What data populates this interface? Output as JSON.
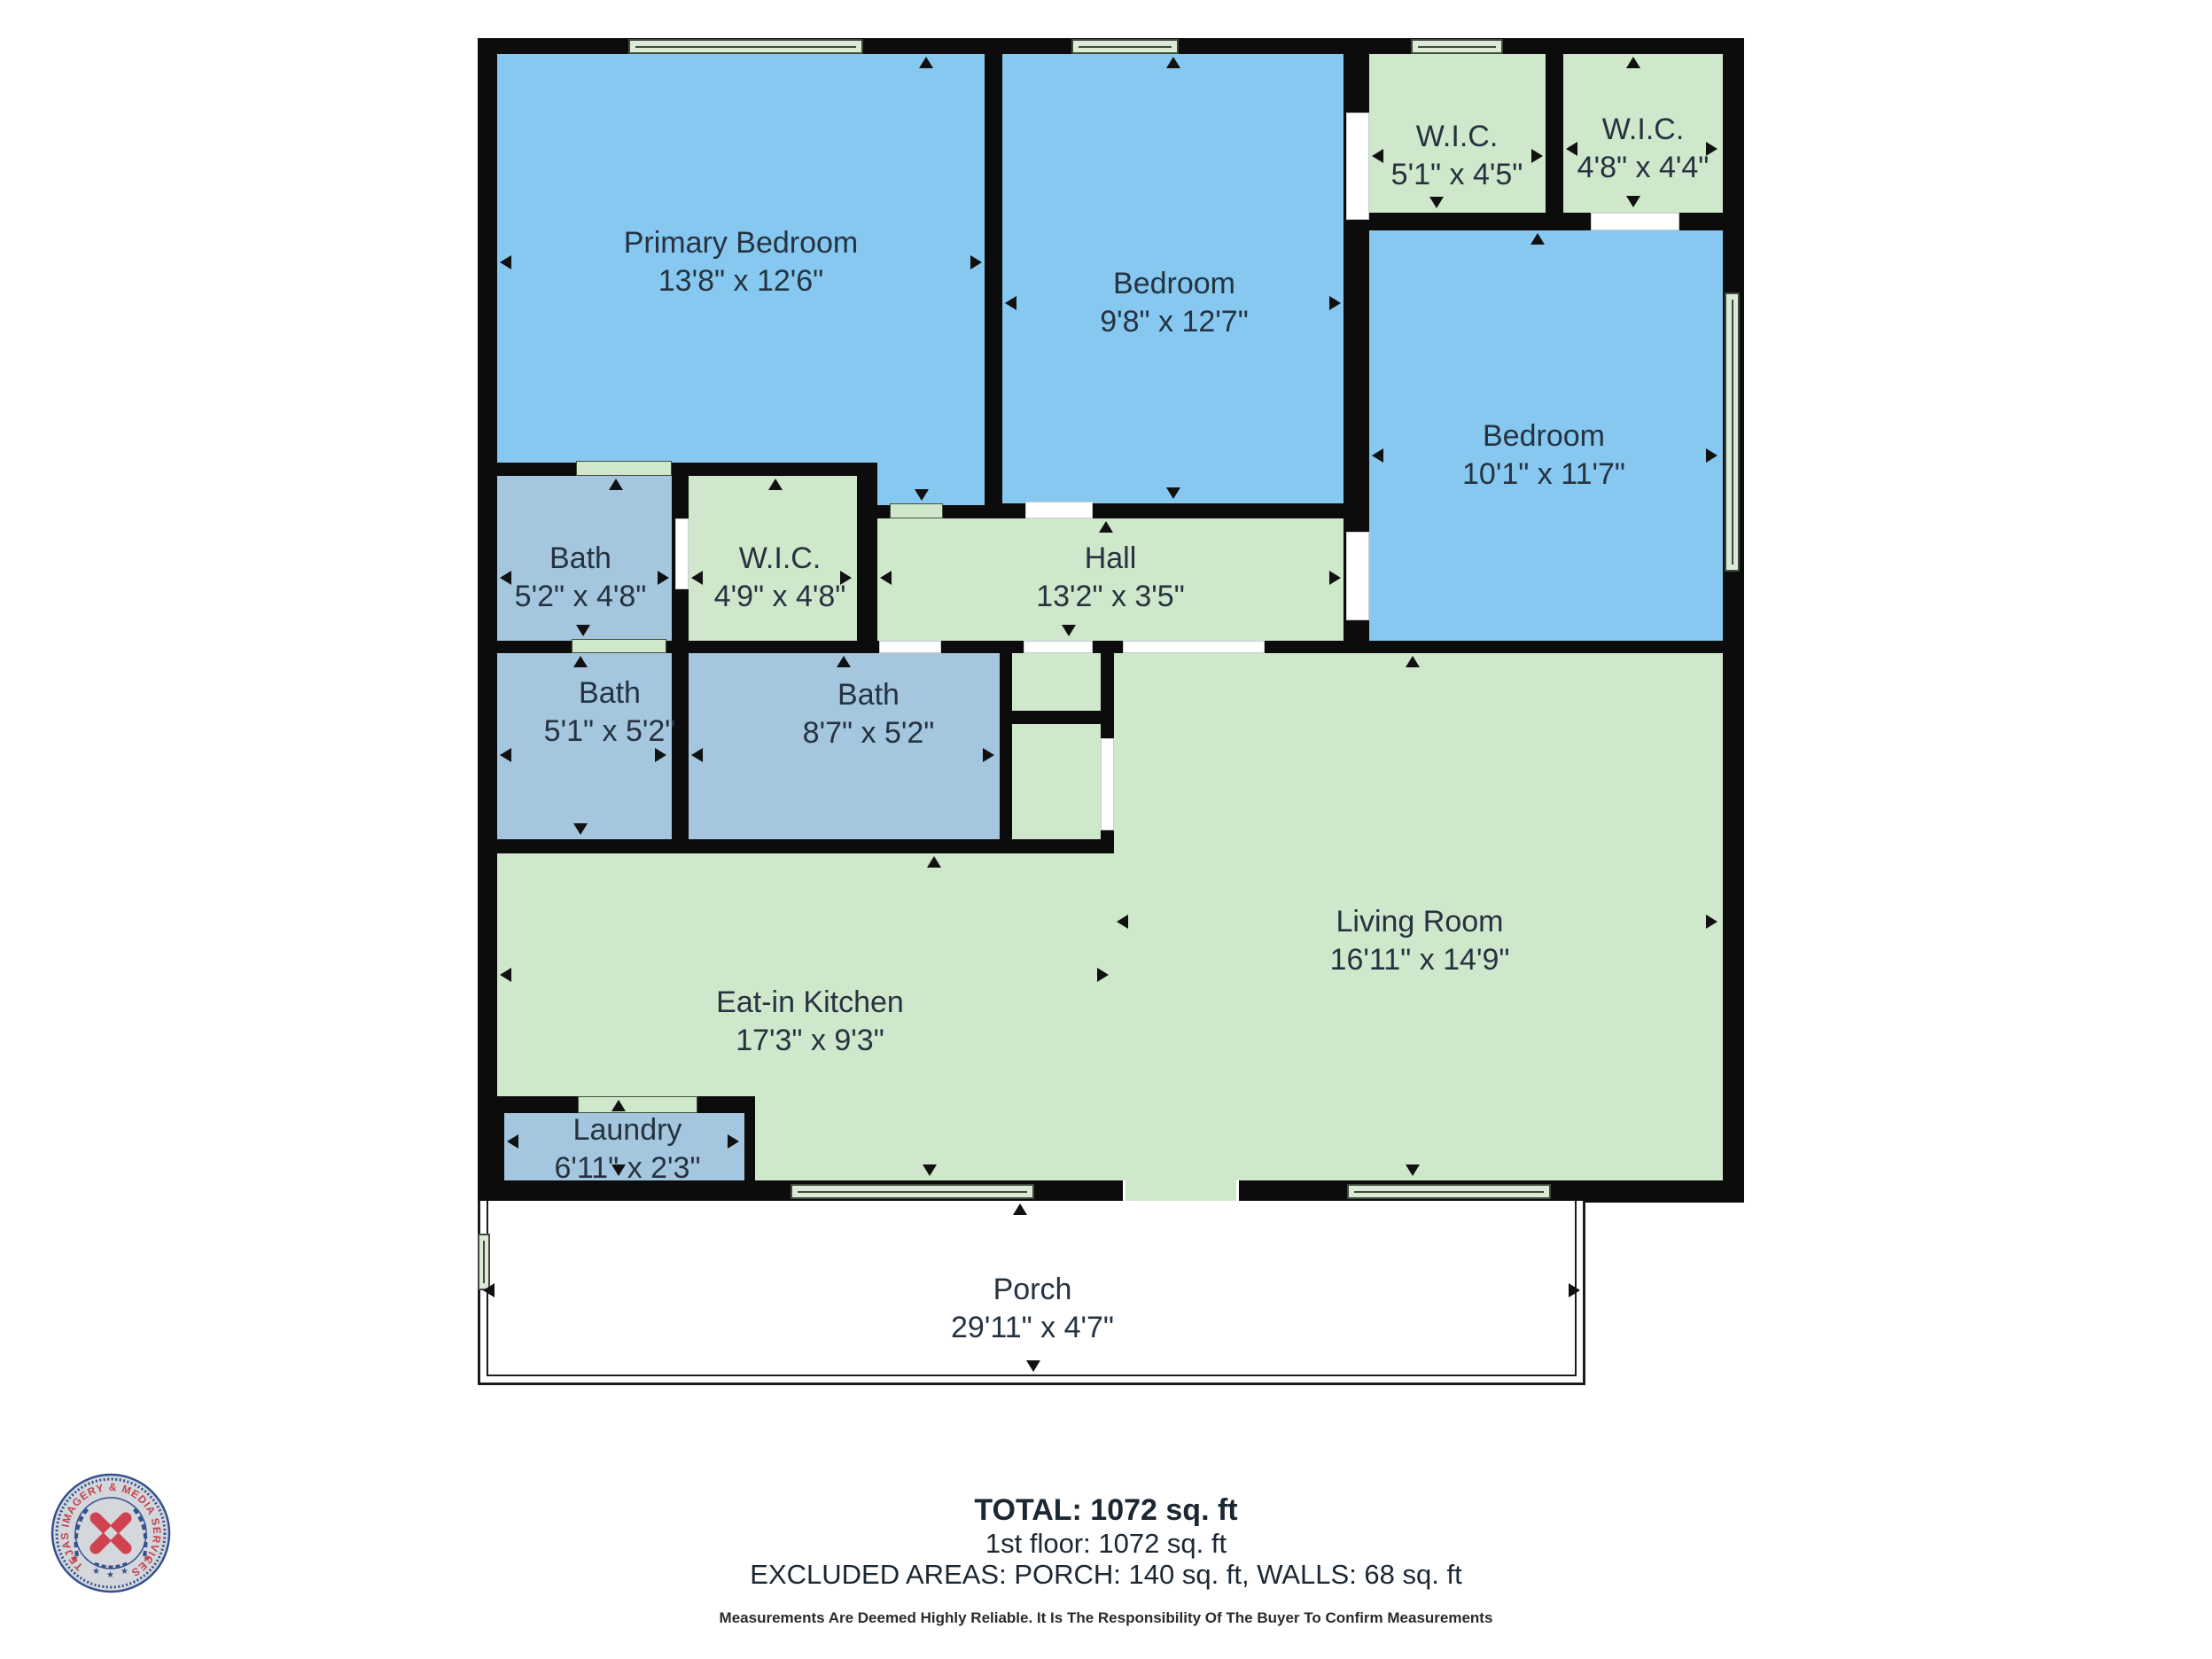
{
  "rooms": [
    {
      "id": "primary-bedroom",
      "name": "Primary Bedroom",
      "dims": "13'8\" x 12'6\""
    },
    {
      "id": "bedroom-2",
      "name": "Bedroom",
      "dims": "9'8\" x 12'7\""
    },
    {
      "id": "wic-1",
      "name": "W.I.C.",
      "dims": "5'1\" x 4'5\""
    },
    {
      "id": "wic-2",
      "name": "W.I.C.",
      "dims": "4'8\" x 4'4\""
    },
    {
      "id": "bedroom-3",
      "name": "Bedroom",
      "dims": "10'1\" x 11'7\""
    },
    {
      "id": "bath-1",
      "name": "Bath",
      "dims": "5'2\" x 4'8\""
    },
    {
      "id": "wic-3",
      "name": "W.I.C.",
      "dims": "4'9\" x 4'8\""
    },
    {
      "id": "hall",
      "name": "Hall",
      "dims": "13'2\" x 3'5\""
    },
    {
      "id": "bath-2",
      "name": "Bath",
      "dims": "5'1\" x 5'2\""
    },
    {
      "id": "bath-3",
      "name": "Bath",
      "dims": "8'7\" x 5'2\""
    },
    {
      "id": "living-room",
      "name": "Living Room",
      "dims": "16'11\" x 14'9\""
    },
    {
      "id": "eat-in-kitchen",
      "name": "Eat-in Kitchen",
      "dims": "17'3\" x 9'3\""
    },
    {
      "id": "laundry",
      "name": "Laundry",
      "dims": "6'11\" x 2'3\""
    },
    {
      "id": "porch",
      "name": "Porch",
      "dims": "29'11\" x 4'7\""
    }
  ],
  "summary": {
    "total": "TOTAL: 1072 sq. ft",
    "first_floor": "1st floor: 1072 sq. ft",
    "excluded": "EXCLUDED AREAS: PORCH: 140 sq. ft, WALLS: 68 sq. ft",
    "disclaimer": "Measurements Are Deemed Highly Reliable. It Is The Responsibility Of The Buyer To Confirm Measurements"
  },
  "logo": {
    "seal_text": "TEJAS IMAGERY & MEDIA SERVICES"
  },
  "colors": {
    "bedroom_fill": "#87c8f0",
    "common_fill": "#cfe7ca",
    "bath_fill": "#a4c6de",
    "window_fill": "#dcead5",
    "wall": "#0c0c0c",
    "label_text": "#253341",
    "seal_blue": "#34508e",
    "seal_red": "#c2424d"
  }
}
